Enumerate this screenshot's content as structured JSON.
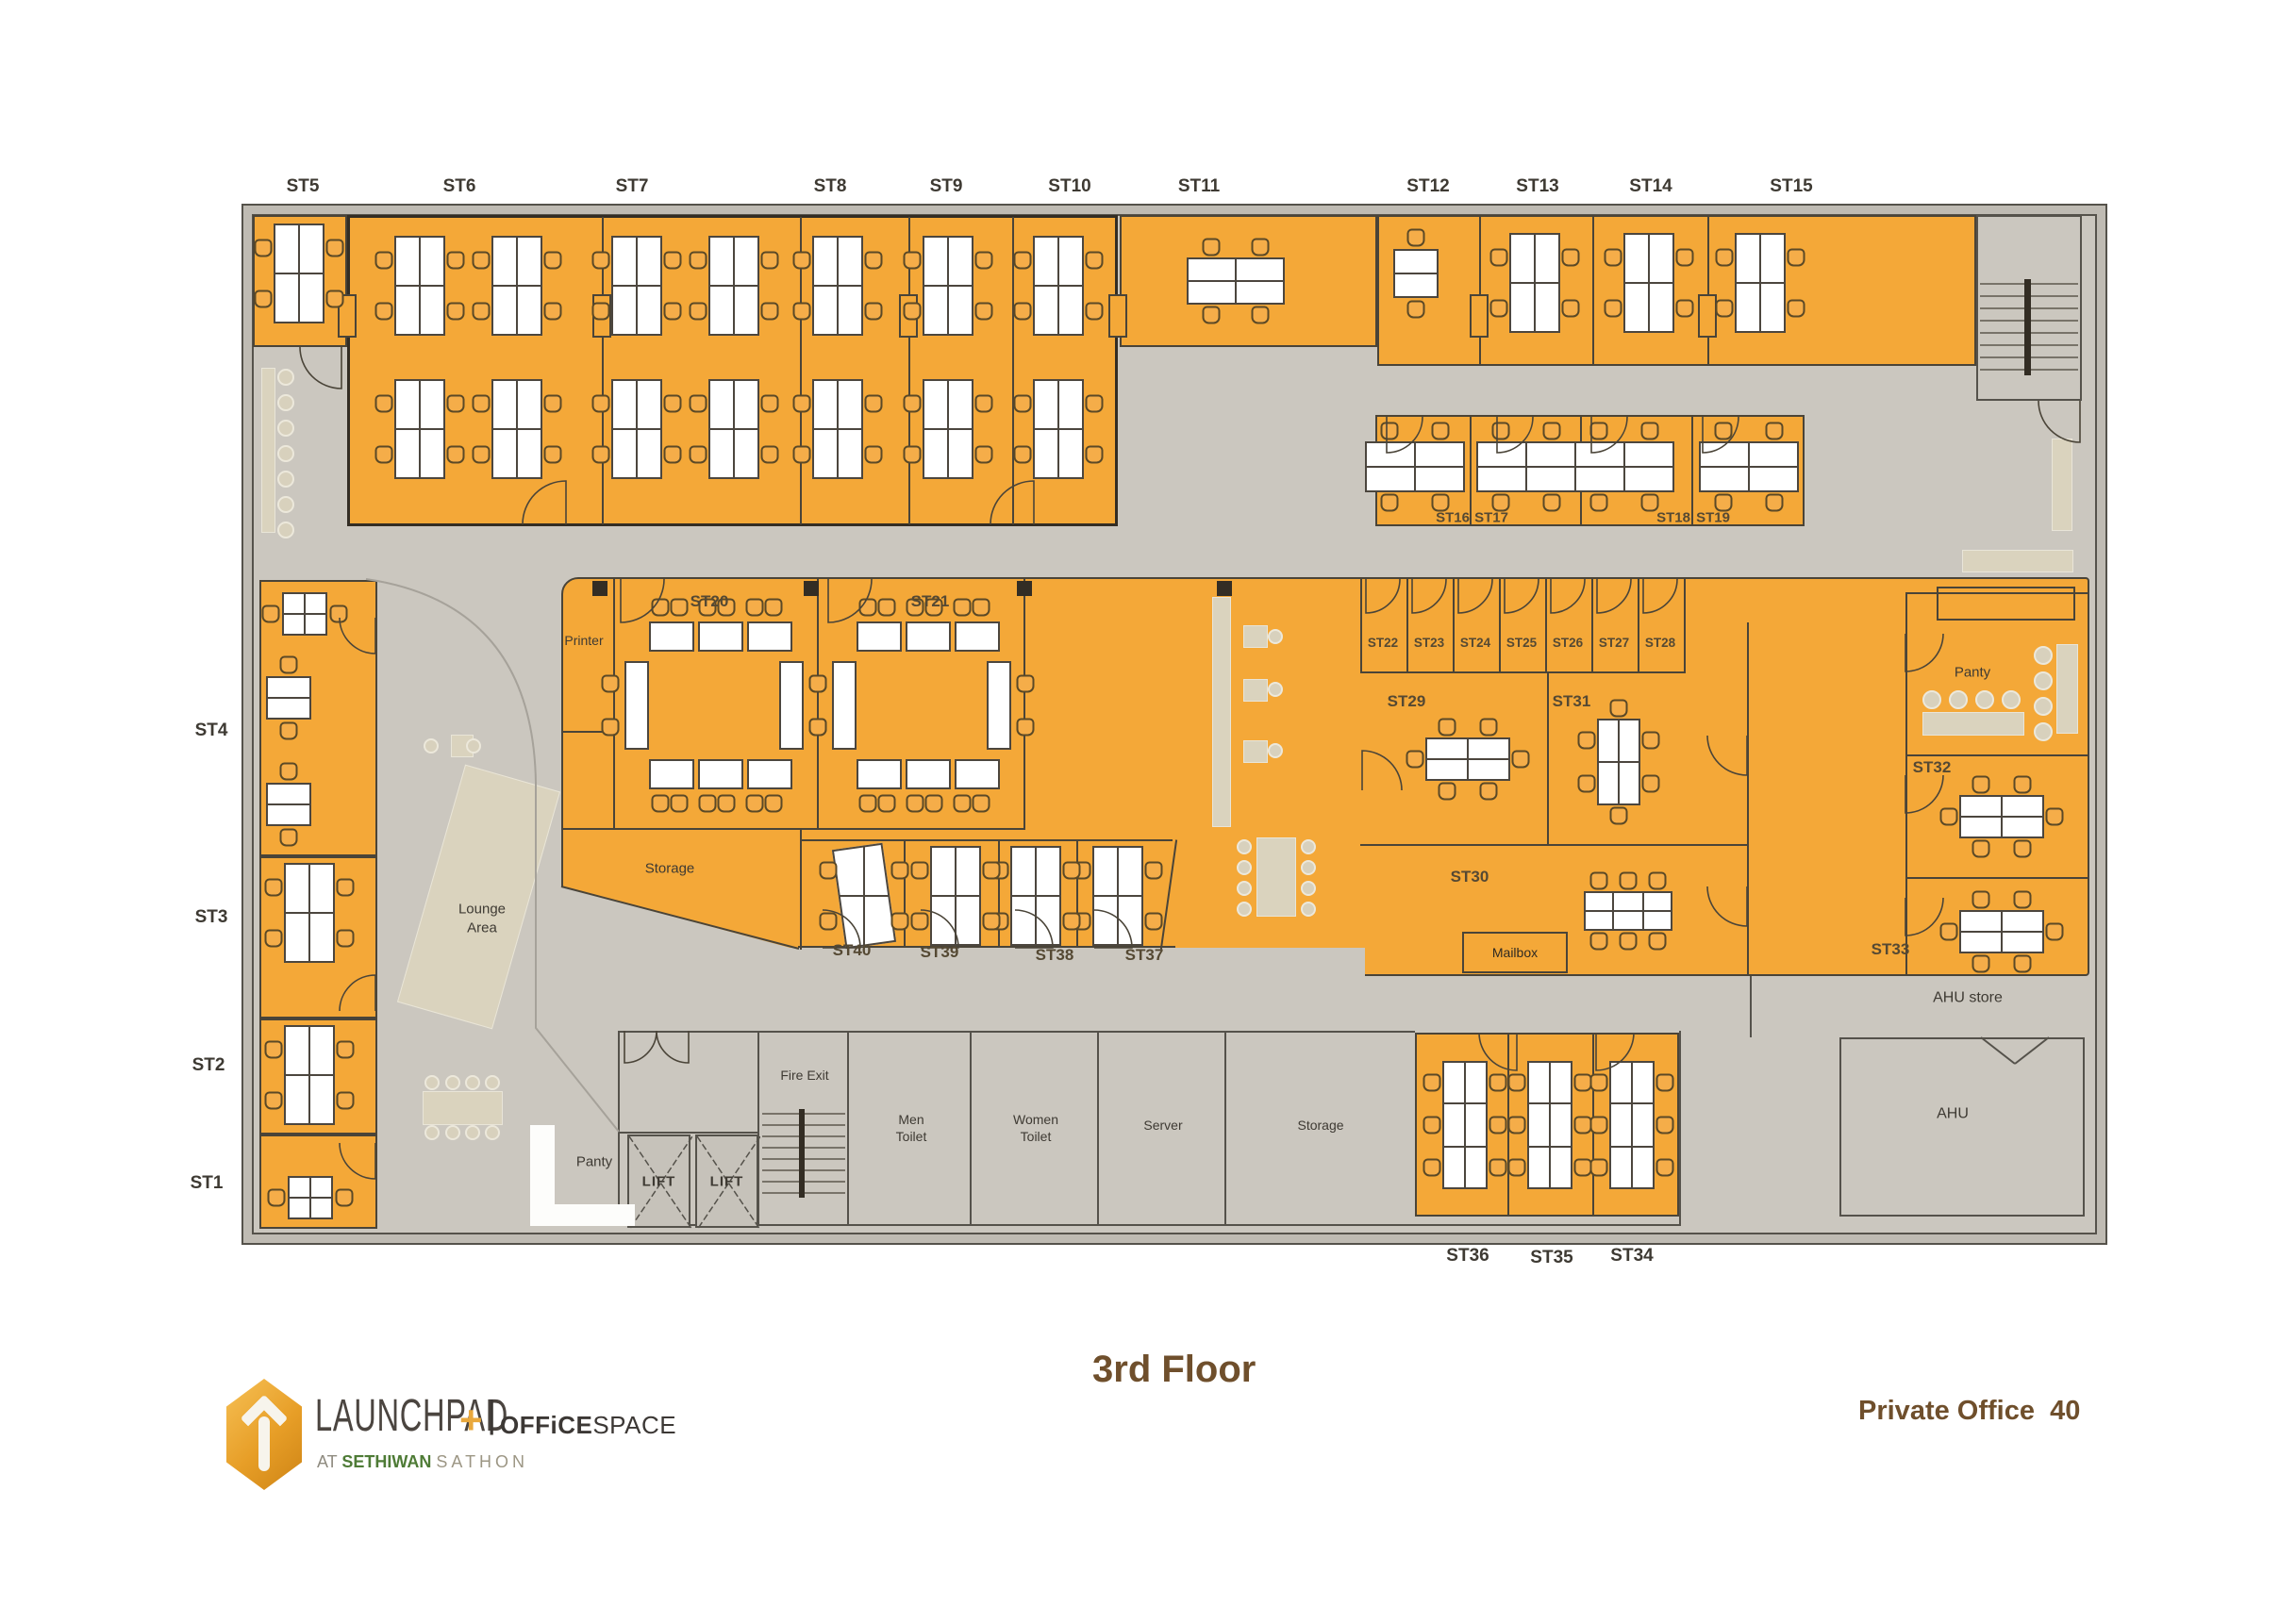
{
  "plan": {
    "top_row_labels": [
      "ST5",
      "ST6",
      "ST7",
      "ST8",
      "ST9",
      "ST10",
      "ST11",
      "ST12",
      "ST13",
      "ST14",
      "ST15"
    ],
    "left_labels": [
      "ST4",
      "ST3",
      "ST2",
      "ST1"
    ],
    "bottom_row_labels": [
      "ST36",
      "ST35",
      "ST34"
    ],
    "rooms": {
      "st16": "ST16",
      "st17": "ST17",
      "st18": "ST18",
      "st19": "ST19",
      "st20": "ST20",
      "st21": "ST21",
      "st22": "ST22",
      "st23": "ST23",
      "st24": "ST24",
      "st25": "ST25",
      "st26": "ST26",
      "st27": "ST27",
      "st28": "ST28",
      "st29": "ST29",
      "st30": "ST30",
      "st31": "ST31",
      "st32": "ST32",
      "st33": "ST33",
      "st37": "ST37",
      "st38": "ST38",
      "st39": "ST39",
      "st40": "ST40"
    },
    "areas": {
      "printer": "Printer",
      "storage_mid": "Storage",
      "lounge": "Lounge Area",
      "panty_left": "Panty",
      "fire_exit": "Fire Exit",
      "men_toilet": "Men Toilet",
      "women_toilet": "Women Toilet",
      "server": "Server",
      "storage_bottom": "Storage",
      "lift": "LIFT",
      "mailbox": "Mailbox",
      "panty_right": "Panty",
      "ahu_store": "AHU store",
      "ahu": "AHU"
    }
  },
  "footer": {
    "floor_title": "3rd Floor",
    "private_office_label": "Private Office",
    "private_office_count": "40",
    "logo": {
      "brand": "LAUNCHPAD",
      "plus": "+",
      "sep": "|",
      "brand2_strong": "OFFiCE",
      "brand2": "SPACE",
      "tag_at": "AT",
      "tag_name": "SETHIWAN",
      "tag_place": "SATHON"
    }
  },
  "colors": {
    "room_orange": "#F4A838",
    "corridor_gray": "#CBC7BF",
    "furniture_beige": "#DAD3BE",
    "wall_dark": "#4A4438",
    "accent_brown": "#6F4F2C"
  }
}
